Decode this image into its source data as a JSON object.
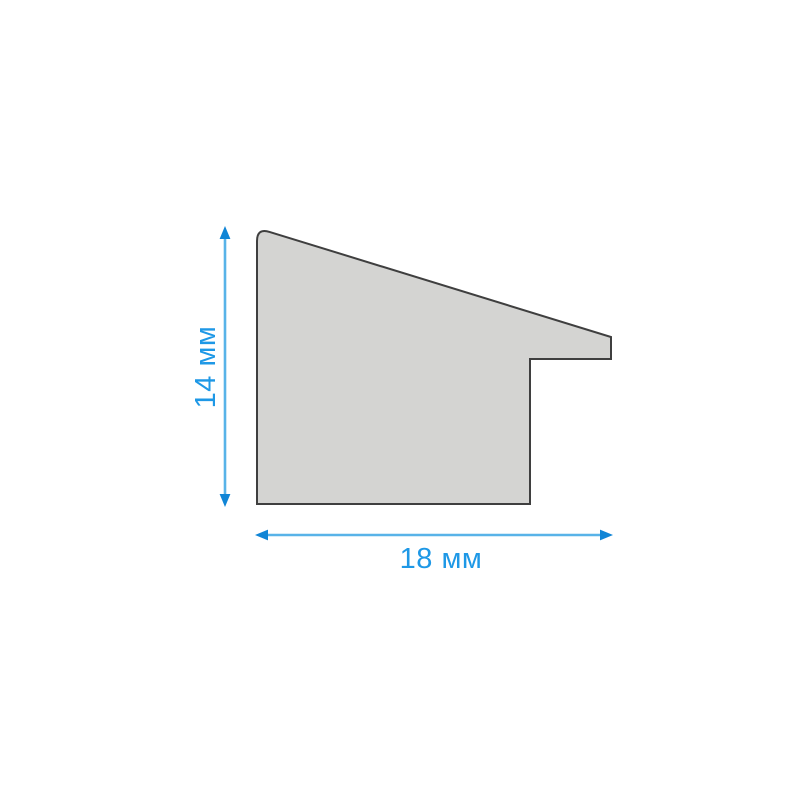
{
  "diagram": {
    "description": "Cross-section profile of a frame moulding with stepped rabbet",
    "profile": {
      "path": "M 257 504 L 257 241 Q 257 228 269.5 231.9 L 611 337 L 611 359 L 530 359 L 530 504 Z"
    },
    "height_dimension": {
      "label": "14 мм",
      "value": 14,
      "unit": "мм"
    },
    "width_dimension": {
      "label": "18 мм",
      "value": 18,
      "unit": "мм"
    },
    "colors": {
      "background": "#ffffff",
      "profile_fill": "#d4d4d2",
      "profile_outline": "#3f3f3f",
      "dimension_line": "#58b3e8",
      "arrowhead": "#1085d6",
      "label_text": "#1e98e6"
    }
  }
}
